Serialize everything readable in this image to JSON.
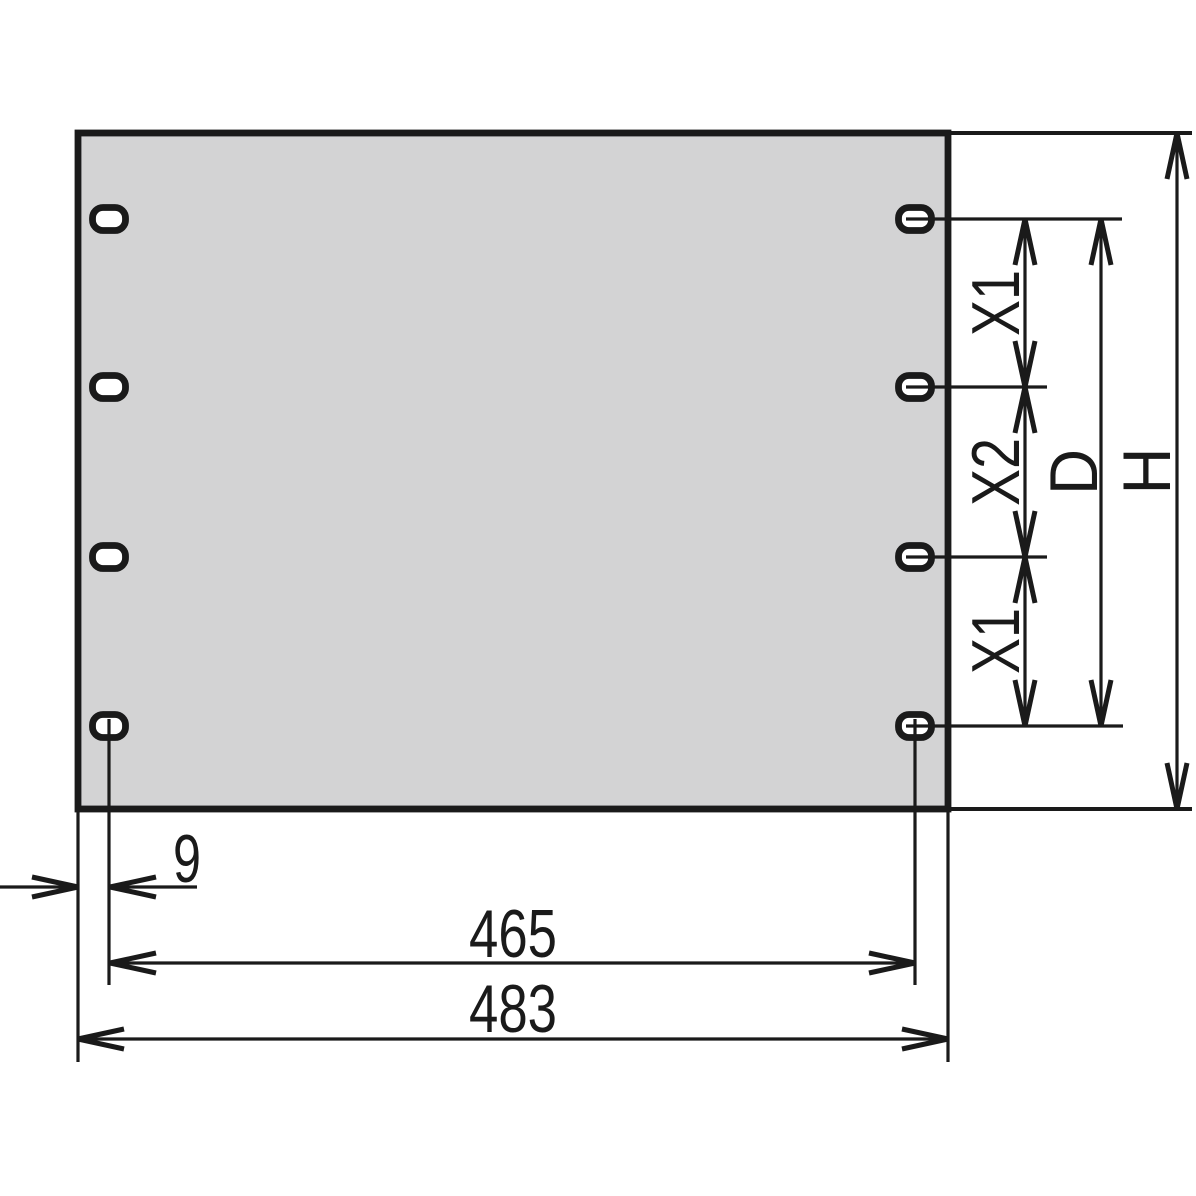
{
  "drawing": {
    "labels": {
      "edge_offset": "9",
      "hole_center_width": "465",
      "overall_width": "483",
      "pitch_top": "X1",
      "pitch_middle": "X2",
      "pitch_bottom": "X1",
      "hole_center_height": "D",
      "overall_height": "H"
    },
    "colors": {
      "background": "#ffffff",
      "panel_fill": "#d3d3d4",
      "line": "#1a1a1a"
    }
  }
}
